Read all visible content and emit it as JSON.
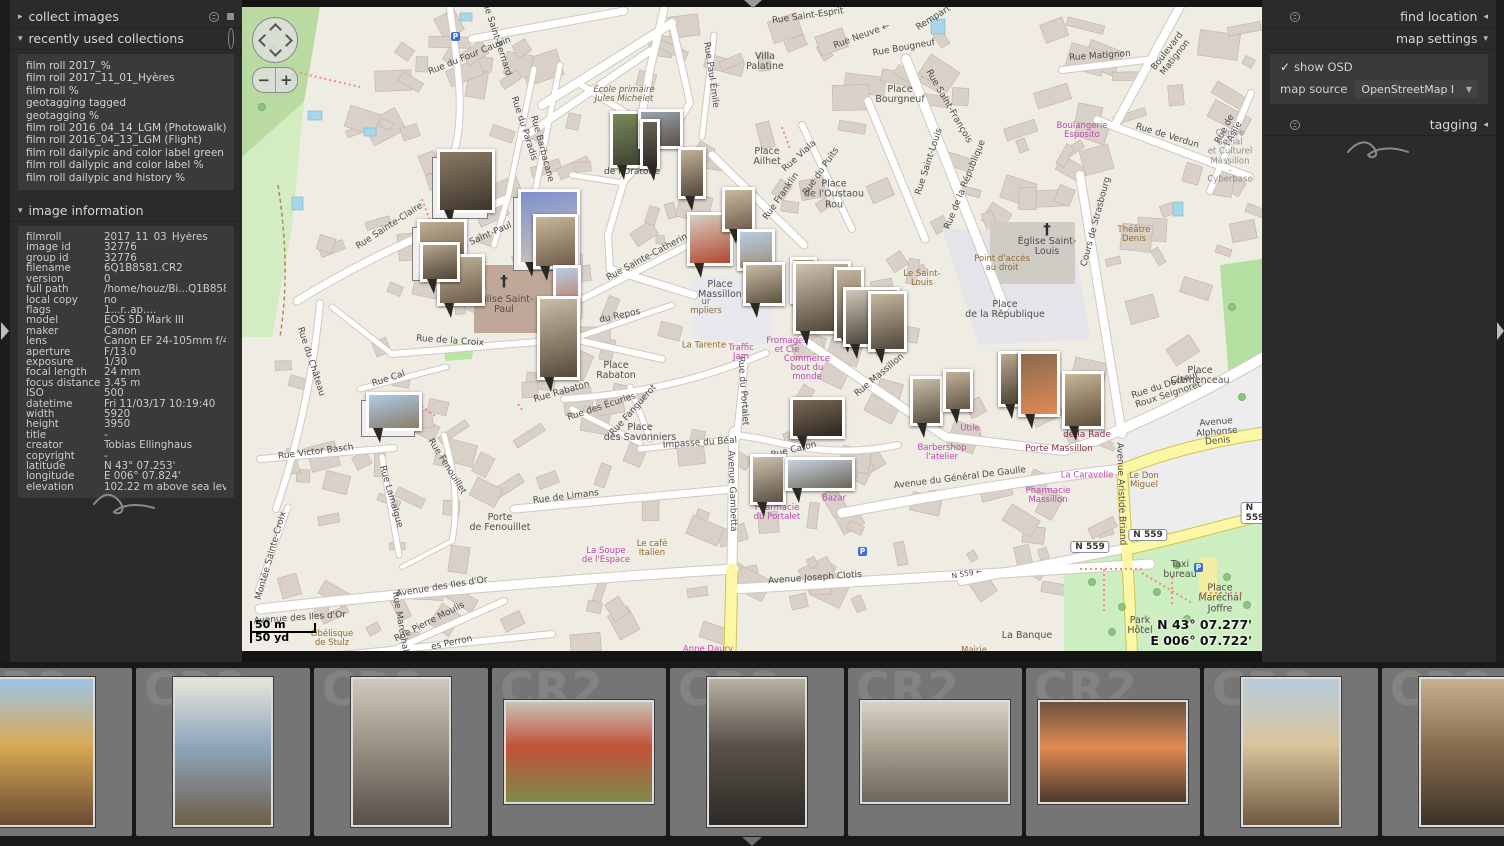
{
  "left_panel": {
    "collect_images_label": "collect images",
    "recent_label": "recently used collections",
    "recent_items": [
      "film roll 2017_%",
      "film roll 2017_11_01_Hyères",
      "film roll %",
      "geotagging tagged",
      "geotagging %",
      "film roll 2016_04_14_LGM (Photowalk)",
      "film roll 2016_04_13_LGM (Flight)",
      "film roll dailypic and color label green",
      "film roll dailypic and color label %",
      "film roll dailypic and history %"
    ],
    "image_info_label": "image information",
    "image_info_rows": [
      [
        "filmroll",
        "2017_11_03_Hyères"
      ],
      [
        "image id",
        "32776"
      ],
      [
        "group id",
        "32776"
      ],
      [
        "filename",
        "6Q1B8581.CR2"
      ],
      [
        "version",
        "0"
      ],
      [
        "full path",
        "/home/houz/Bi...Q1B8581.CR2"
      ],
      [
        "local copy",
        "no"
      ],
      [
        "flags",
        "1...r..ap...."
      ],
      [
        "model",
        "EOS 5D Mark III"
      ],
      [
        "maker",
        "Canon"
      ],
      [
        "lens",
        "Canon EF 24-105mm f/4L IS"
      ],
      [
        "aperture",
        "F/13.0"
      ],
      [
        "exposure",
        "1/30"
      ],
      [
        "focal length",
        "24 mm"
      ],
      [
        "focus distance",
        "3.45 m"
      ],
      [
        "ISO",
        "500"
      ],
      [
        "datetime",
        "Fri 11/03/17 10:19:40"
      ],
      [
        "width",
        "5920"
      ],
      [
        "height",
        "3950"
      ],
      [
        "title",
        "-"
      ],
      [
        "creator",
        "Tobias Ellinghaus"
      ],
      [
        "copyright",
        "-"
      ],
      [
        "latitude",
        "N 43° 07.253'"
      ],
      [
        "longitude",
        "E 006° 07.824'"
      ],
      [
        "elevation",
        "102.22 m above sea level"
      ]
    ]
  },
  "right_panel": {
    "find_location_label": "find location",
    "map_settings_label": "map settings",
    "show_osd_label": "show OSD",
    "map_source_label": "map source",
    "map_source_value": "OpenStreetMap I",
    "tagging_label": "tagging"
  },
  "map": {
    "scale_m": "50 m",
    "scale_yd": "50 yd",
    "coord_lat": "N 43° 07.277'",
    "coord_lon": "E 006° 07.722'",
    "shields": [
      {
        "t": "N 559",
        "x": 848,
        "y": 540
      },
      {
        "t": "N 559",
        "x": 906,
        "y": 528
      },
      {
        "t": "N 559",
        "x": 1013,
        "y": 506
      }
    ],
    "labels": [
      [
        "Rue Saint-Esprit",
        566,
        10,
        -8,
        "st"
      ],
      [
        "Rue Neuve ←",
        620,
        30,
        -20,
        "st"
      ],
      [
        "Rempart",
        692,
        12,
        -32,
        "st"
      ],
      [
        "Rue Bougneuf",
        662,
        42,
        -10,
        "st"
      ],
      [
        "Place\nBourgneuf",
        658,
        88,
        0,
        "pl"
      ],
      [
        "Rue Saint-François",
        706,
        100,
        60,
        "st"
      ],
      [
        "Rue Matignon",
        858,
        50,
        -4,
        "st"
      ],
      [
        "Boulevard Matignon",
        930,
        48,
        -52,
        "st"
      ],
      [
        "Boulangerie\nEsposito",
        840,
        124,
        0,
        "poi"
      ],
      [
        "Rue de Verdun",
        925,
        130,
        17,
        "st"
      ],
      [
        "Rue de l'Asile",
        988,
        125,
        -62,
        "st"
      ],
      [
        "Centre\nSocial\net Culturel\nMassillon\n- Cyberbase",
        988,
        150,
        0,
        "area"
      ],
      [
        "Villa\nPalatine",
        523,
        55,
        0,
        "pl"
      ],
      [
        "Rue Paul Émile",
        468,
        68,
        82,
        "st"
      ],
      [
        "École primaire\nJules Michelet",
        382,
        88,
        0,
        "sch"
      ],
      [
        "Rue Barbacane",
        299,
        142,
        75,
        "st"
      ],
      [
        "Rue du Four Cauvin",
        228,
        50,
        -22,
        "st"
      ],
      [
        "Rue Saint-Bernard",
        253,
        30,
        72,
        "st"
      ],
      [
        "Rue du Paradis",
        281,
        122,
        72,
        "st"
      ],
      [
        "de l'Oratoire",
        390,
        166,
        0,
        "st"
      ],
      [
        "Place\nAilhet",
        525,
        150,
        0,
        "pl"
      ],
      [
        "Rue Viala",
        558,
        150,
        -42,
        "st"
      ],
      [
        "Rue Franklin",
        540,
        190,
        -55,
        "st"
      ],
      [
        "Place\nde l'Oustaou\nRou",
        592,
        188,
        0,
        "pl"
      ],
      [
        "Rue du Puits",
        580,
        165,
        -55,
        "st"
      ],
      [
        "Rue Saint-Louis",
        688,
        155,
        -72,
        "st"
      ],
      [
        "Le Saint-\nLouis",
        680,
        272,
        0,
        "am"
      ],
      [
        "Point d'accès\nau droit",
        760,
        257,
        0,
        "am"
      ],
      [
        "Place\nde la République",
        763,
        303,
        0,
        "pl"
      ],
      [
        "Rue de la République",
        724,
        178,
        -68,
        "st"
      ],
      [
        "Cours de Strasbourg",
        855,
        215,
        -75,
        "st"
      ],
      [
        "Théâtre\nDenis",
        892,
        228,
        0,
        "am"
      ],
      [
        "Église Saint-\nLouis",
        805,
        240,
        0,
        "pl"
      ],
      [
        "Rue Sainte-Catherine",
        408,
        250,
        -28,
        "st"
      ],
      [
        "du Repos",
        378,
        310,
        -12,
        "st"
      ],
      [
        "Rue Sainte-Claire",
        148,
        220,
        -33,
        "st"
      ],
      [
        "Rue du Château",
        68,
        355,
        72,
        "st"
      ],
      [
        "Église Saint-\nPaul",
        262,
        298,
        0,
        "pl"
      ],
      [
        "Rue Saint-Paul",
        240,
        232,
        -24,
        "st"
      ],
      [
        "Rue de la Croix",
        208,
        335,
        4,
        "st"
      ],
      [
        "Rue Cal",
        147,
        373,
        -18,
        "st"
      ],
      [
        "Place\nRabaton",
        374,
        364,
        0,
        "pl"
      ],
      [
        "Rue Rabaton",
        320,
        386,
        -16,
        "st"
      ],
      [
        "Rue des Écuries",
        360,
        401,
        -18,
        "st"
      ],
      [
        "Rue Fanguerot",
        392,
        404,
        -48,
        "st"
      ],
      [
        "Place\ndes Savonniers",
        398,
        426,
        0,
        "pl"
      ],
      [
        "Impasse du Béal",
        458,
        437,
        -4,
        "st"
      ],
      [
        "Rue Caton",
        552,
        444,
        -14,
        "st"
      ],
      [
        "Rue du Portalet",
        500,
        384,
        86,
        "st"
      ],
      [
        "Rue Massillon",
        638,
        369,
        -40,
        "st"
      ],
      [
        "Place\nMassillon",
        478,
        283,
        0,
        "pl"
      ],
      [
        "ur\nmpliers",
        464,
        300,
        0,
        "am"
      ],
      [
        "La Tarente",
        462,
        339,
        0,
        "am"
      ],
      [
        "Traffic\nJam",
        499,
        346,
        0,
        "poi"
      ],
      [
        "Fromages\net Cie",
        545,
        339,
        0,
        "poi"
      ],
      [
        "Commerce\nbout du\nmonde",
        565,
        362,
        0,
        "poi"
      ],
      [
        "Utile",
        728,
        422,
        0,
        "poi"
      ],
      [
        "Barbershop\nl'atelier",
        700,
        446,
        0,
        "poi"
      ],
      [
        "Porte Massillon",
        817,
        443,
        0,
        "gate"
      ],
      [
        "de la Rade",
        845,
        429,
        0,
        "gate"
      ],
      [
        "Rue du Docteur Roux Seignoret",
        925,
        384,
        -18,
        "st"
      ],
      [
        "Place\nClemenceau",
        958,
        369,
        0,
        "pl"
      ],
      [
        "Avenue Alphonse Denis",
        975,
        426,
        -5,
        "st"
      ],
      [
        "Avenue Aristide Briand",
        878,
        487,
        88,
        "st"
      ],
      [
        "Avenue du Général De Gaulle",
        718,
        472,
        -7,
        "st"
      ],
      [
        "La Caravelle",
        845,
        469,
        0,
        "poi"
      ],
      [
        "Le Don\nMiguel",
        902,
        474,
        0,
        "am"
      ],
      [
        "Pharmacie\nMassillon",
        806,
        489,
        0,
        "poi"
      ],
      [
        "Pharmacie\ndu Portalet",
        535,
        506,
        0,
        "poi"
      ],
      [
        "Bazar",
        592,
        492,
        0,
        "poi"
      ],
      [
        "Avenue Gambetta",
        489,
        484,
        88,
        "st"
      ],
      [
        "La Soupe\nde l'Espace",
        364,
        549,
        0,
        "poi"
      ],
      [
        "Le café\nItalien",
        410,
        542,
        0,
        "am"
      ],
      [
        "Anne Daury",
        466,
        643,
        0,
        "poi"
      ],
      [
        "Avenue des Iles d'Or",
        200,
        581,
        -9,
        "st"
      ],
      [
        "Avenue des Iles d'Or",
        58,
        612,
        -4,
        "st"
      ],
      [
        "Rue de Limans",
        324,
        491,
        -7,
        "st"
      ],
      [
        "Porte\nde Fenouillet",
        258,
        516,
        0,
        "pl"
      ],
      [
        "Rue Fenouillet",
        204,
        460,
        58,
        "st"
      ],
      [
        "Rue Lamalgue",
        148,
        490,
        74,
        "st"
      ],
      [
        "Montée Sainte-Croix",
        30,
        549,
        -74,
        "st"
      ],
      [
        "Rue Victor Basch",
        74,
        446,
        -7,
        "st"
      ],
      [
        "Rue Pierre Moulis",
        188,
        616,
        -27,
        "st"
      ],
      [
        "es Perron",
        210,
        637,
        -12,
        "st"
      ],
      [
        "Rue Maréchal",
        157,
        615,
        80,
        "st"
      ],
      [
        "Obélisque\nde Stulz",
        90,
        632,
        0,
        "am"
      ],
      [
        "Avenue Joseph Clotis",
        573,
        572,
        -4,
        "st"
      ],
      [
        "N 559 ←",
        725,
        567,
        -10,
        "small"
      ],
      [
        "La Banque",
        785,
        629,
        0,
        "pl"
      ],
      [
        "Mairie",
        732,
        644,
        0,
        "am"
      ],
      [
        "Taxi\nbureau",
        938,
        563,
        0,
        "pl"
      ],
      [
        "Place\nMaréchal\nJoffre",
        978,
        592,
        0,
        "pl"
      ],
      [
        "Park\nHôtel",
        898,
        619,
        0,
        "pl"
      ]
    ],
    "markers": [
      [
        195,
        142,
        58,
        64,
        "#8a7a64",
        "#3e362c",
        1
      ],
      [
        276,
        182,
        62,
        76,
        "#7d90cf",
        "#cfc6b4",
        1
      ],
      [
        291,
        207,
        45,
        55,
        "#c9b79a",
        "#6d5d49",
        0
      ],
      [
        311,
        258,
        28,
        52,
        "#b8cfe4",
        "#c06a48",
        0
      ],
      [
        295,
        289,
        43,
        84,
        "#cbbda6",
        "#54493a",
        0
      ],
      [
        175,
        212,
        50,
        56,
        "#bfae92",
        "#5e5242",
        1
      ],
      [
        195,
        247,
        48,
        52,
        "#c3b49a",
        "#6a5c48",
        0
      ],
      [
        178,
        235,
        40,
        40,
        "#b5a58c",
        "#4e4436",
        0
      ],
      [
        368,
        104,
        37,
        57,
        "#7a8a5a",
        "#3c402e",
        0
      ],
      [
        396,
        102,
        45,
        40,
        "#9aa4ae",
        "#5a5248",
        0
      ],
      [
        398,
        112,
        20,
        50,
        "#6a6258",
        "#2e2a24",
        0
      ],
      [
        436,
        140,
        28,
        52,
        "#c0b098",
        "#52483a",
        0
      ],
      [
        445,
        205,
        46,
        54,
        "#d8cfc0",
        "#b04830",
        0
      ],
      [
        480,
        180,
        33,
        45,
        "#c9b99e",
        "#6e6050",
        0
      ],
      [
        495,
        222,
        38,
        42,
        "#b6cde6",
        "#a08e74",
        0
      ],
      [
        501,
        255,
        42,
        44,
        "#c9bda8",
        "#5c5040",
        0
      ],
      [
        548,
        250,
        27,
        47,
        "#baa88e",
        "#463c30",
        0
      ],
      [
        551,
        254,
        58,
        73,
        "#cfc4b0",
        "#4a4034",
        0
      ],
      [
        592,
        260,
        30,
        74,
        "#c3b49c",
        "#544a3c",
        0
      ],
      [
        601,
        280,
        57,
        60,
        "#d2c9b8",
        "#3a342c",
        0
      ],
      [
        626,
        284,
        39,
        61,
        "#c6b8a0",
        "#50463a",
        0
      ],
      [
        668,
        369,
        33,
        50,
        "#cbbfa8",
        "#584e40",
        0
      ],
      [
        701,
        362,
        30,
        43,
        "#c2b29a",
        "#635648",
        0
      ],
      [
        756,
        344,
        24,
        56,
        "#b8a88e",
        "#4c4236",
        0
      ],
      [
        776,
        344,
        42,
        66,
        "#8a6a4e",
        "#e08a54",
        0
      ],
      [
        820,
        364,
        42,
        58,
        "#c9b696",
        "#5e4e3c",
        0
      ],
      [
        124,
        385,
        56,
        39,
        "#aecce8",
        "#8a7a66",
        1
      ],
      [
        548,
        390,
        55,
        42,
        "#7a6a55",
        "#2c2620",
        0
      ],
      [
        508,
        447,
        36,
        51,
        "#cfc2ae",
        "#5a5044",
        0
      ],
      [
        543,
        450,
        70,
        34,
        "#c8d4e0",
        "#6a6456",
        0
      ]
    ]
  },
  "filmstrip": {
    "ghost": "CR2",
    "thumbs": [
      [
        "p",
        "#9ec4e8",
        "#d9aa55",
        "#6b4a33"
      ],
      [
        "p",
        "#e8e4da",
        "#8fa8bc",
        "#6e5f4c"
      ],
      [
        "p",
        "#cfc8bc",
        "#9a9284",
        "#57504a"
      ],
      [
        "l",
        "#c9c2b4",
        "#c25038",
        "#7d8a4a"
      ],
      [
        "p",
        "#b8b0a2",
        "#5a524a",
        "#2e2a26"
      ],
      [
        "l",
        "#d8d2c6",
        "#a89e90",
        "#6e665c"
      ],
      [
        "l",
        "#6b5140",
        "#e08a52",
        "#4a3a2c"
      ],
      [
        "p",
        "#b8ccdd",
        "#d9c49c",
        "#6e5a42"
      ],
      [
        "p",
        "#c8b190",
        "#8a6f4f",
        "#3c3228"
      ]
    ]
  }
}
